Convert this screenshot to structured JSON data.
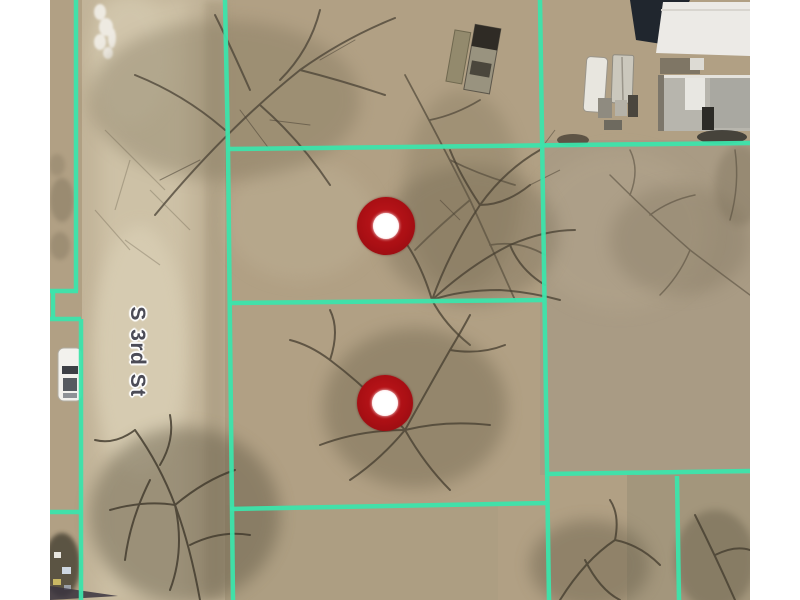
{
  "map": {
    "street_label": "S 3rd St",
    "street_label_pos": {
      "x": 137,
      "y": 352,
      "rotation_deg": 90
    },
    "street_label_color": "#4c4c57",
    "parcel_line_color": "#3ce4ab",
    "parcel_line_width": 4.5,
    "marker_outer_color": "#aa0f14",
    "marker_inner_color": "#ffffff",
    "markers": [
      {
        "x": 386,
        "y": 226,
        "outer_r": 29,
        "inner_r": 13
      },
      {
        "x": 385,
        "y": 403,
        "outer_r": 28,
        "inner_r": 13
      }
    ],
    "parcel_lines": [
      {
        "x1": 76,
        "y1": 0,
        "x2": 76,
        "y2": 291
      },
      {
        "x1": 50,
        "y1": 291,
        "x2": 78,
        "y2": 291
      },
      {
        "x1": 53,
        "y1": 291,
        "x2": 53,
        "y2": 319
      },
      {
        "x1": 50,
        "y1": 319,
        "x2": 81,
        "y2": 319
      },
      {
        "x1": 81,
        "y1": 319,
        "x2": 81,
        "y2": 600
      },
      {
        "x1": 50,
        "y1": 512,
        "x2": 81,
        "y2": 512
      },
      {
        "x1": 225,
        "y1": 0,
        "x2": 228,
        "y2": 148
      },
      {
        "x1": 228,
        "y1": 148,
        "x2": 233,
        "y2": 600
      },
      {
        "x1": 228,
        "y1": 149,
        "x2": 750,
        "y2": 143
      },
      {
        "x1": 540,
        "y1": 0,
        "x2": 549,
        "y2": 600
      },
      {
        "x1": 230,
        "y1": 303,
        "x2": 544,
        "y2": 300
      },
      {
        "x1": 546,
        "y1": 474,
        "x2": 750,
        "y2": 471
      },
      {
        "x1": 677,
        "y1": 476,
        "x2": 679,
        "y2": 600
      },
      {
        "x1": 230,
        "y1": 509,
        "x2": 546,
        "y2": 503
      }
    ],
    "canvas": {
      "width": 800,
      "height": 600,
      "content_left": 50,
      "content_right": 750,
      "border_color": "#ffffff"
    }
  }
}
